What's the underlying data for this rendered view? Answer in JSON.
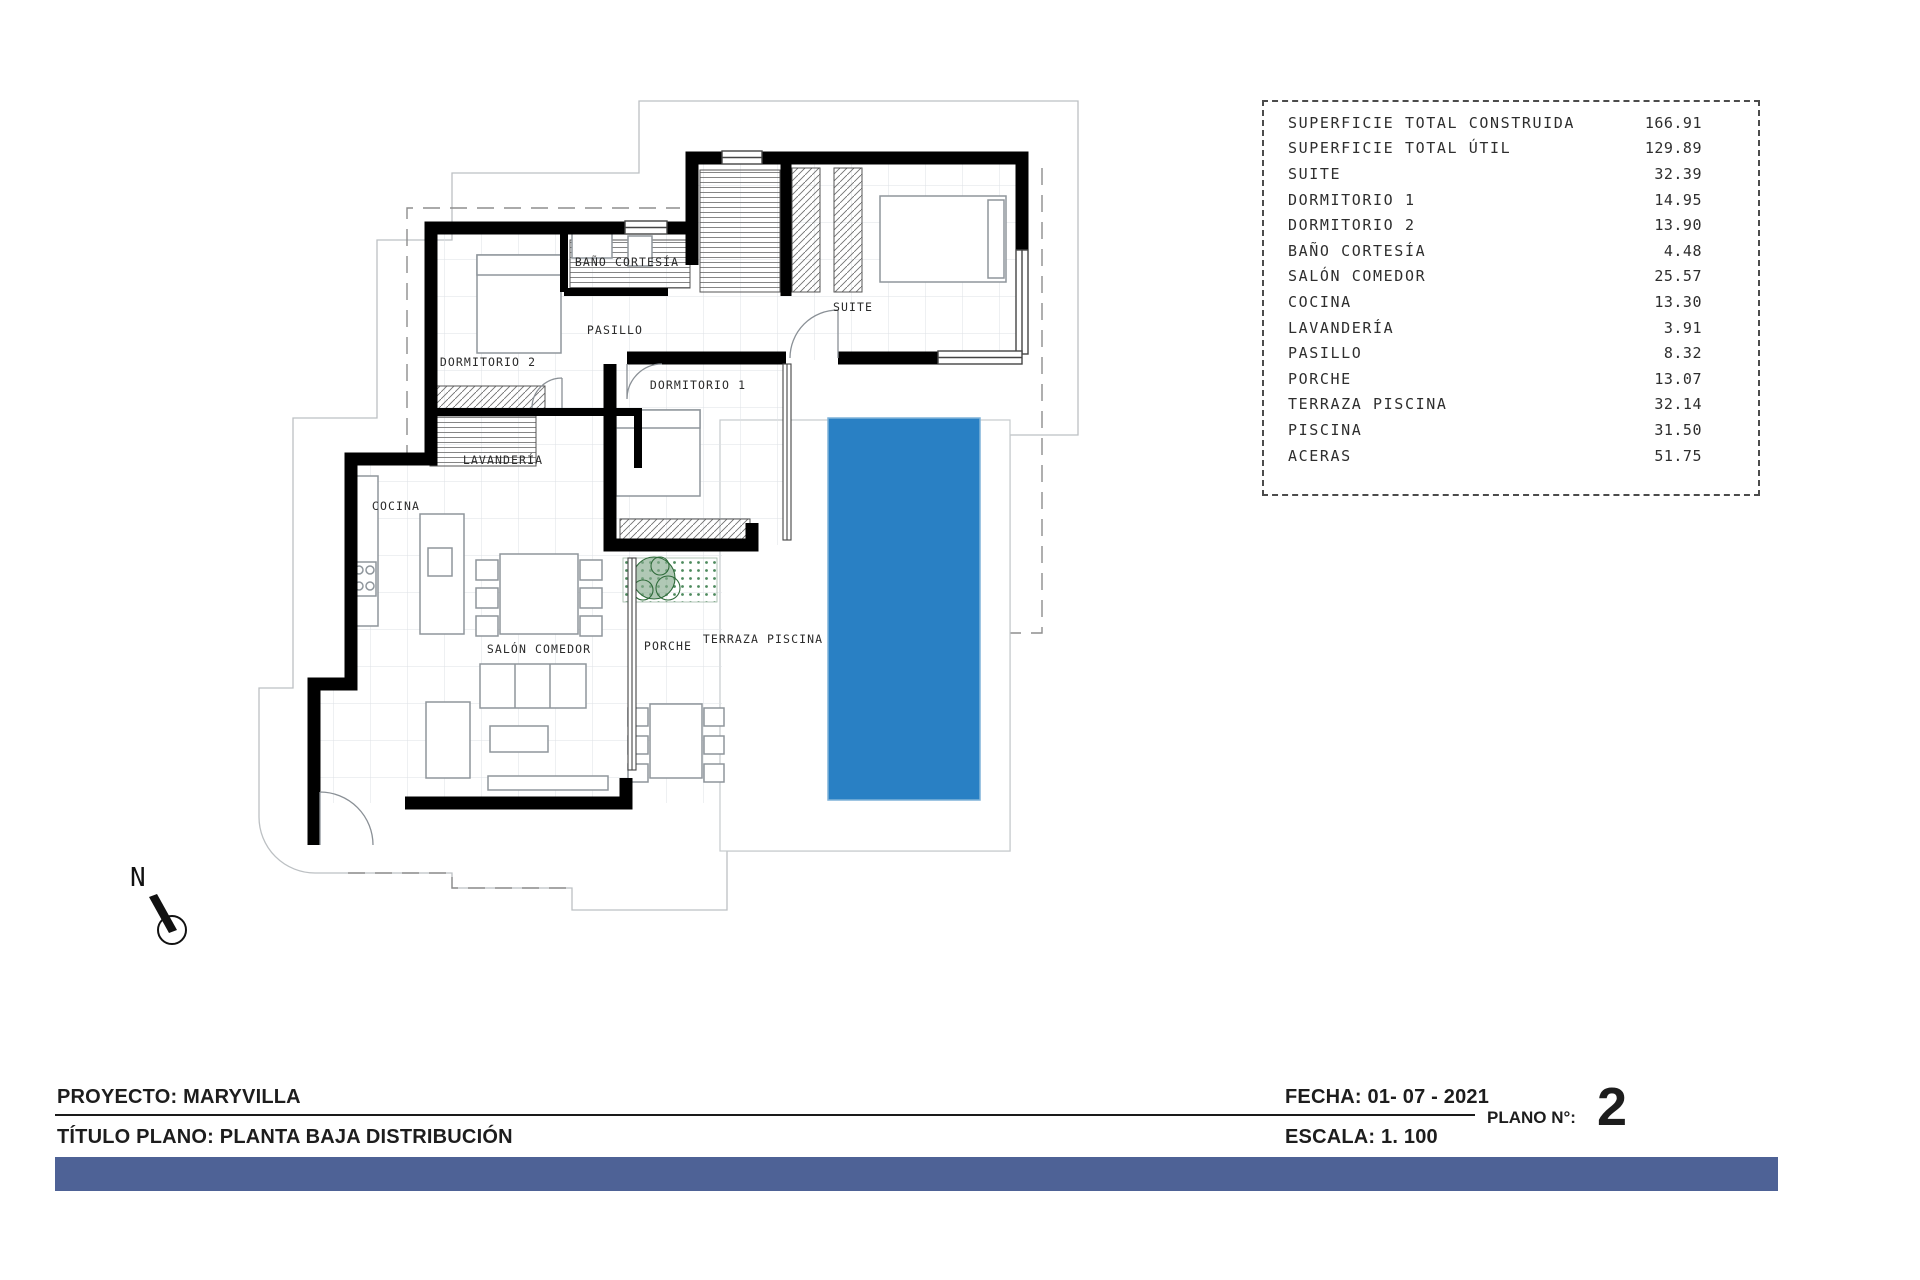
{
  "summary_table": {
    "rows": [
      {
        "label": "SUPERFICIE TOTAL CONSTRUIDA",
        "value": "166.91"
      },
      {
        "label": "SUPERFICIE TOTAL ÚTIL",
        "value": "129.89"
      },
      {
        "label": "SUITE",
        "value": "32.39"
      },
      {
        "label": "DORMITORIO 1",
        "value": "14.95"
      },
      {
        "label": "DORMITORIO 2",
        "value": "13.90"
      },
      {
        "label": "BAÑO CORTESÍA",
        "value": "4.48"
      },
      {
        "label": "SALÓN COMEDOR",
        "value": "25.57"
      },
      {
        "label": "COCINA",
        "value": "13.30"
      },
      {
        "label": "LAVANDERÍA",
        "value": "3.91"
      },
      {
        "label": "PASILLO",
        "value": "8.32"
      },
      {
        "label": "PORCHE",
        "value": "13.07"
      },
      {
        "label": "TERRAZA PISCINA",
        "value": "32.14"
      },
      {
        "label": "PISCINA",
        "value": "31.50"
      },
      {
        "label": "ACERAS",
        "value": "51.75"
      }
    ]
  },
  "plan": {
    "rooms": [
      {
        "label": "DORMITORIO 2"
      },
      {
        "label": "BAÑO CORTESÍA"
      },
      {
        "label": "PASILLO"
      },
      {
        "label": "SUITE"
      },
      {
        "label": "DORMITORIO 1"
      },
      {
        "label": "LAVANDERÍA"
      },
      {
        "label": "COCINA"
      },
      {
        "label": "SALÓN COMEDOR"
      },
      {
        "label": "PORCHE"
      },
      {
        "label": "TERRAZA PISCINA"
      }
    ],
    "north_label": "N",
    "colors": {
      "pool": "#2980c4",
      "accent_bar": "#4e6296",
      "walls": "#000000"
    }
  },
  "title_block": {
    "project": "PROYECTO: MARYVILLA",
    "plan_title": "TÍTULO PLANO: PLANTA BAJA DISTRIBUCIÓN",
    "date": "FECHA: 01- 07 - 2021",
    "scale": "ESCALA: 1. 100",
    "plan_number_label": "PLANO N°:",
    "plan_number": "2"
  }
}
